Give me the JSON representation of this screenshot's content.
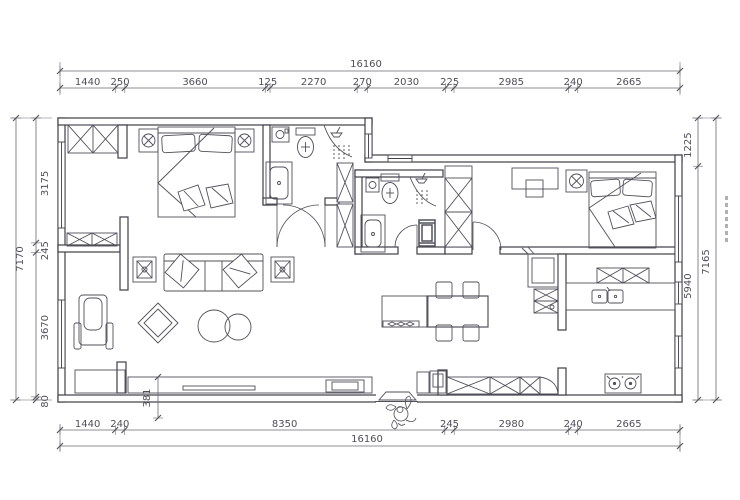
{
  "drawing": {
    "type": "floor-plan",
    "units": "mm",
    "dimensions": {
      "top": {
        "total": "16160",
        "segments": [
          "1440",
          "250",
          "3660",
          "125",
          "2270",
          "270",
          "2030",
          "225",
          "2985",
          "240",
          "2665"
        ]
      },
      "bottom": {
        "total": "16160",
        "segments": [
          "1440",
          "240",
          "8350",
          "245",
          "2980",
          "240",
          "2665"
        ]
      },
      "left": {
        "total": "7170",
        "segments": [
          "3175",
          "245",
          "3670",
          "80"
        ]
      },
      "right": {
        "total": "7165",
        "segments": [
          "1225",
          "5940"
        ]
      },
      "detail_dims": [
        {
          "label": "381",
          "location": "tv-wall"
        }
      ]
    },
    "colors": {
      "wall_line": "#3e3e47",
      "furniture_line": "#50505a",
      "dimension_line": "#6a6a74",
      "dimension_text": "#4f4f58",
      "background": "#ffffff"
    }
  }
}
